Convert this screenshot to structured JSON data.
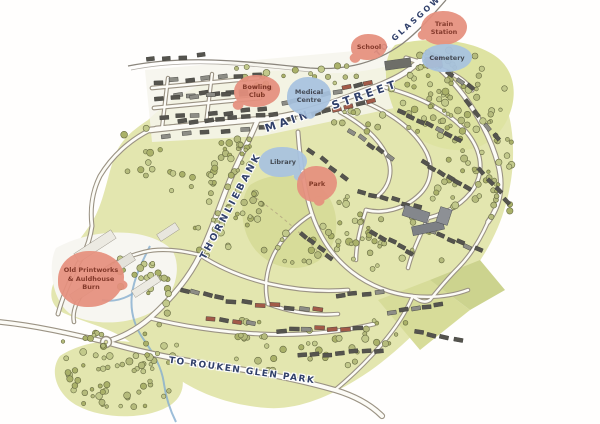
{
  "map": {
    "style": "hand-drawn illustrated town map",
    "places": [
      {
        "id": "bowling-club",
        "label": "Bowling Club",
        "bubble_color": "red"
      },
      {
        "id": "medical-centre",
        "label": "Medical Centre",
        "bubble_color": "blue"
      },
      {
        "id": "school",
        "label": "School",
        "bubble_color": "red"
      },
      {
        "id": "train-station",
        "label": "Train Station",
        "bubble_color": "red"
      },
      {
        "id": "cemetery",
        "label": "Cemetery",
        "bubble_color": "blue"
      },
      {
        "id": "library",
        "label": "Library",
        "bubble_color": "blue"
      },
      {
        "id": "park",
        "label": "Park",
        "bubble_color": "red"
      },
      {
        "id": "printworks",
        "label": "Old Printworks & Auldhouse Burn",
        "bubble_color": "red"
      }
    ],
    "roads": [
      {
        "id": "to-glasgow",
        "label": "TO GLASGOW"
      },
      {
        "id": "main-street",
        "label": "MAIN STREET"
      },
      {
        "id": "thornliebank",
        "label": "THORNLIEBANK"
      },
      {
        "id": "rouken-glen",
        "label": "TO ROUKEN GLEN PARK"
      }
    ],
    "colors": {
      "bubble_red": "#e6907e",
      "bubble_red_text": "#7c2d1e",
      "bubble_blue": "#a8c3e0",
      "bubble_blue_text": "#39404e",
      "road_label_text": "#31406a",
      "paper": "#fffefd",
      "green_base": "#e3e6af",
      "green_dark": "#d7dc99",
      "tree_fill": "#b5bb7c",
      "tree_stroke": "#676b42",
      "road_fill": "#fcfbf6",
      "road_casing": "#9b9384",
      "railway": "#8a857c",
      "building_dark": "#55544e",
      "building_red": "#a25a48",
      "building_light": "#8d8d86",
      "water": "#85aed0"
    }
  }
}
